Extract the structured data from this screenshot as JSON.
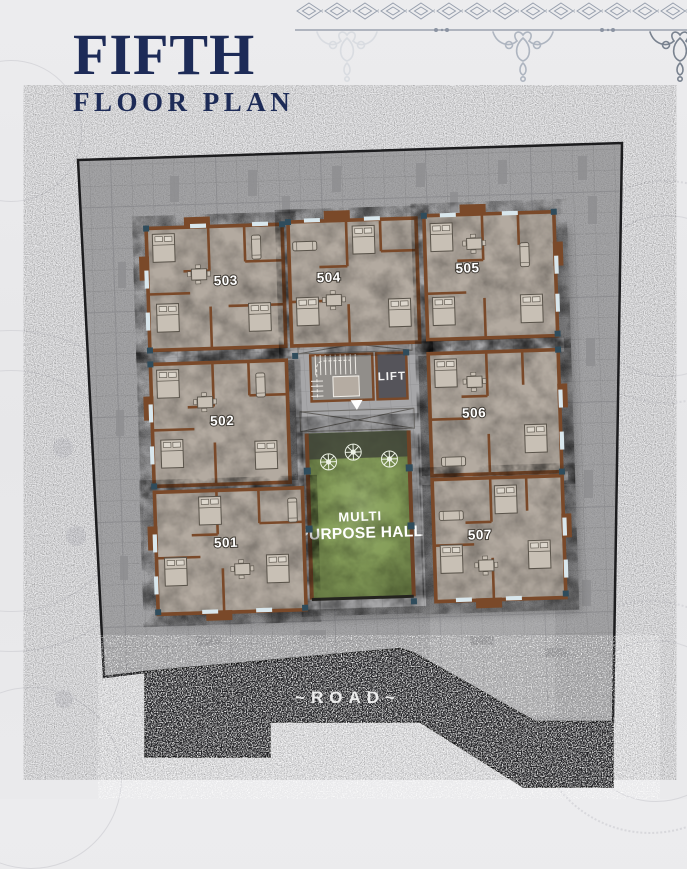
{
  "header": {
    "title": "FIFTH",
    "subtitle": "FLOOR PLAN"
  },
  "plan": {
    "units": [
      "501",
      "502",
      "503",
      "504",
      "505",
      "506",
      "507"
    ],
    "lift_label": "LIFT",
    "hall": {
      "line1": "MULTI",
      "line2": "PURPOSE HALL"
    },
    "road_label": "~ROAD~"
  },
  "colors": {
    "title_navy": "#1d2b57",
    "wall_brown": "#7a4929",
    "floor_taupe": "#b3aaa0",
    "hall_green": "#8da75f",
    "road_dark": "#232227",
    "site_gray": "#a6a6a8",
    "column_blue": "#2f4c5c",
    "ornament_gray": "#aab1bc"
  }
}
